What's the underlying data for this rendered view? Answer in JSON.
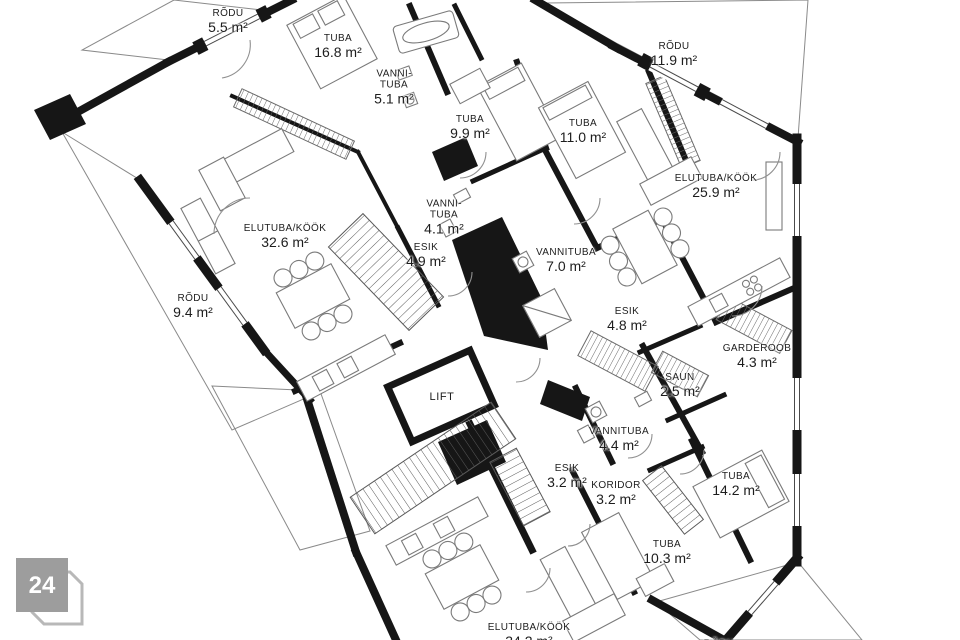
{
  "plan": {
    "wall_color": "#161616",
    "hatch_color": "#8a8a8a",
    "furniture_line_color": "#7a7a7a",
    "label_color": "#1d1d1d",
    "badge_color": "#9d9d9d"
  },
  "badge": {
    "number": "24"
  },
  "rooms": [
    {
      "name": "RÕDU",
      "area": "5.5 m²"
    },
    {
      "name": "TUBA",
      "area": "16.8 m²"
    },
    {
      "name": "VANNI­TUBA",
      "area": "5.1 m²"
    },
    {
      "name": "TUBA",
      "area": "9.9 m²"
    },
    {
      "name": "TUBA",
      "area": "11.0 m²"
    },
    {
      "name": "RÕDU",
      "area": "11.9 m²"
    },
    {
      "name": "ELUTUBA/KÖÖK",
      "area": "25.9 m²"
    },
    {
      "name": "VANNI­TUBA",
      "area": "4.1 m²"
    },
    {
      "name": "ESIK",
      "area": "4.9 m²"
    },
    {
      "name": "VANNITUBA",
      "area": "7.0 m²"
    },
    {
      "name": "ELUTUBA/KÖÖK",
      "area": "32.6 m²"
    },
    {
      "name": "RÕDU",
      "area": "9.4 m²"
    },
    {
      "name": "ESIK",
      "area": "4.8 m²"
    },
    {
      "name": "GARDEROOB",
      "area": "4.3 m²"
    },
    {
      "name": "SAUN",
      "area": "2.5 m²"
    },
    {
      "name": "VANNITUBA",
      "area": "4.4 m²"
    },
    {
      "name": "LIFT",
      "area": ""
    },
    {
      "name": "ESIK",
      "area": "3.2 m²"
    },
    {
      "name": "KORIDOR",
      "area": "3.2 m²"
    },
    {
      "name": "TUBA",
      "area": "14.2 m²"
    },
    {
      "name": "TUBA",
      "area": "10.3 m²"
    },
    {
      "name": "ELUTUBA/KÖÖK",
      "area": "34.2 m²"
    },
    {
      "name": "RÕDU",
      "area": ""
    }
  ]
}
